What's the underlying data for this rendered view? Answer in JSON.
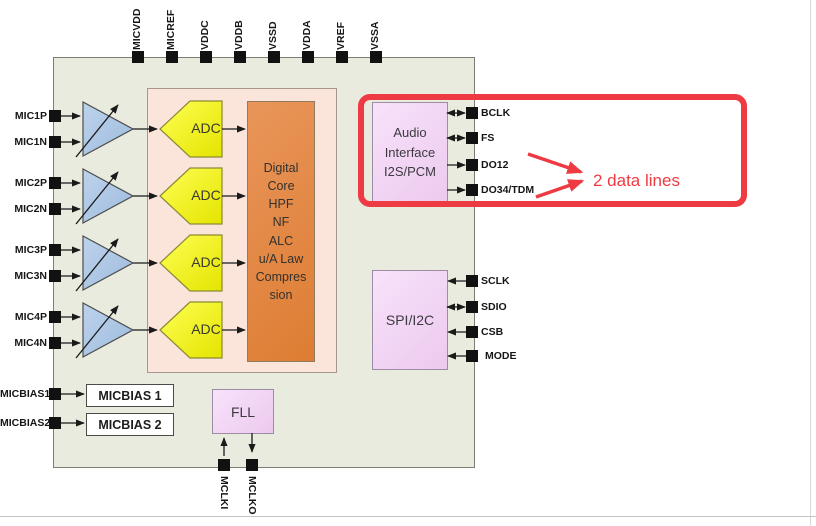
{
  "chip": {
    "top_pins": [
      "MICVDD",
      "MICREF",
      "VDDC",
      "VDDB",
      "VSSD",
      "VDDA",
      "VREF",
      "VSSA"
    ],
    "left_pins": [
      "MIC1P",
      "MIC1N",
      "MIC2P",
      "MIC2N",
      "MIC3P",
      "MIC3N",
      "MIC4P",
      "MIC4N"
    ],
    "bias_pins": [
      "MICBIAS1",
      "MICBIAS2"
    ],
    "audio_pins": [
      "BCLK",
      "FS",
      "DO12",
      "DO34/TDM"
    ],
    "ctrl_pins": [
      "SCLK",
      "SDIO",
      "CSB",
      "MODE"
    ],
    "bottom_pins": [
      "MCLKI",
      "MCLKO"
    ]
  },
  "blocks": {
    "adc_label": "ADC",
    "digital_core": "Digital\nCore\nHPF\nNF\nALC\nu/A Law\nCompres\nsion",
    "audio_interface": "Audio\nInterface\nI2S/PCM",
    "spi": "SPI/I2C",
    "fll": "FLL",
    "micbias1": "MICBIAS 1",
    "micbias2": "MICBIAS 2"
  },
  "annotation": {
    "text": "2 data lines",
    "color": "#ee3b43"
  },
  "colors": {
    "chip_bg": "#e9ebdf",
    "analog_container": "#fbe5da",
    "adc_yellow": "#f2f200",
    "core_orange": "#e2843e",
    "interface_lavender": "#f3d6f5",
    "amp_blue": "#abc7e6",
    "annotation_red": "#ee3b43",
    "pin_black": "#111111"
  }
}
